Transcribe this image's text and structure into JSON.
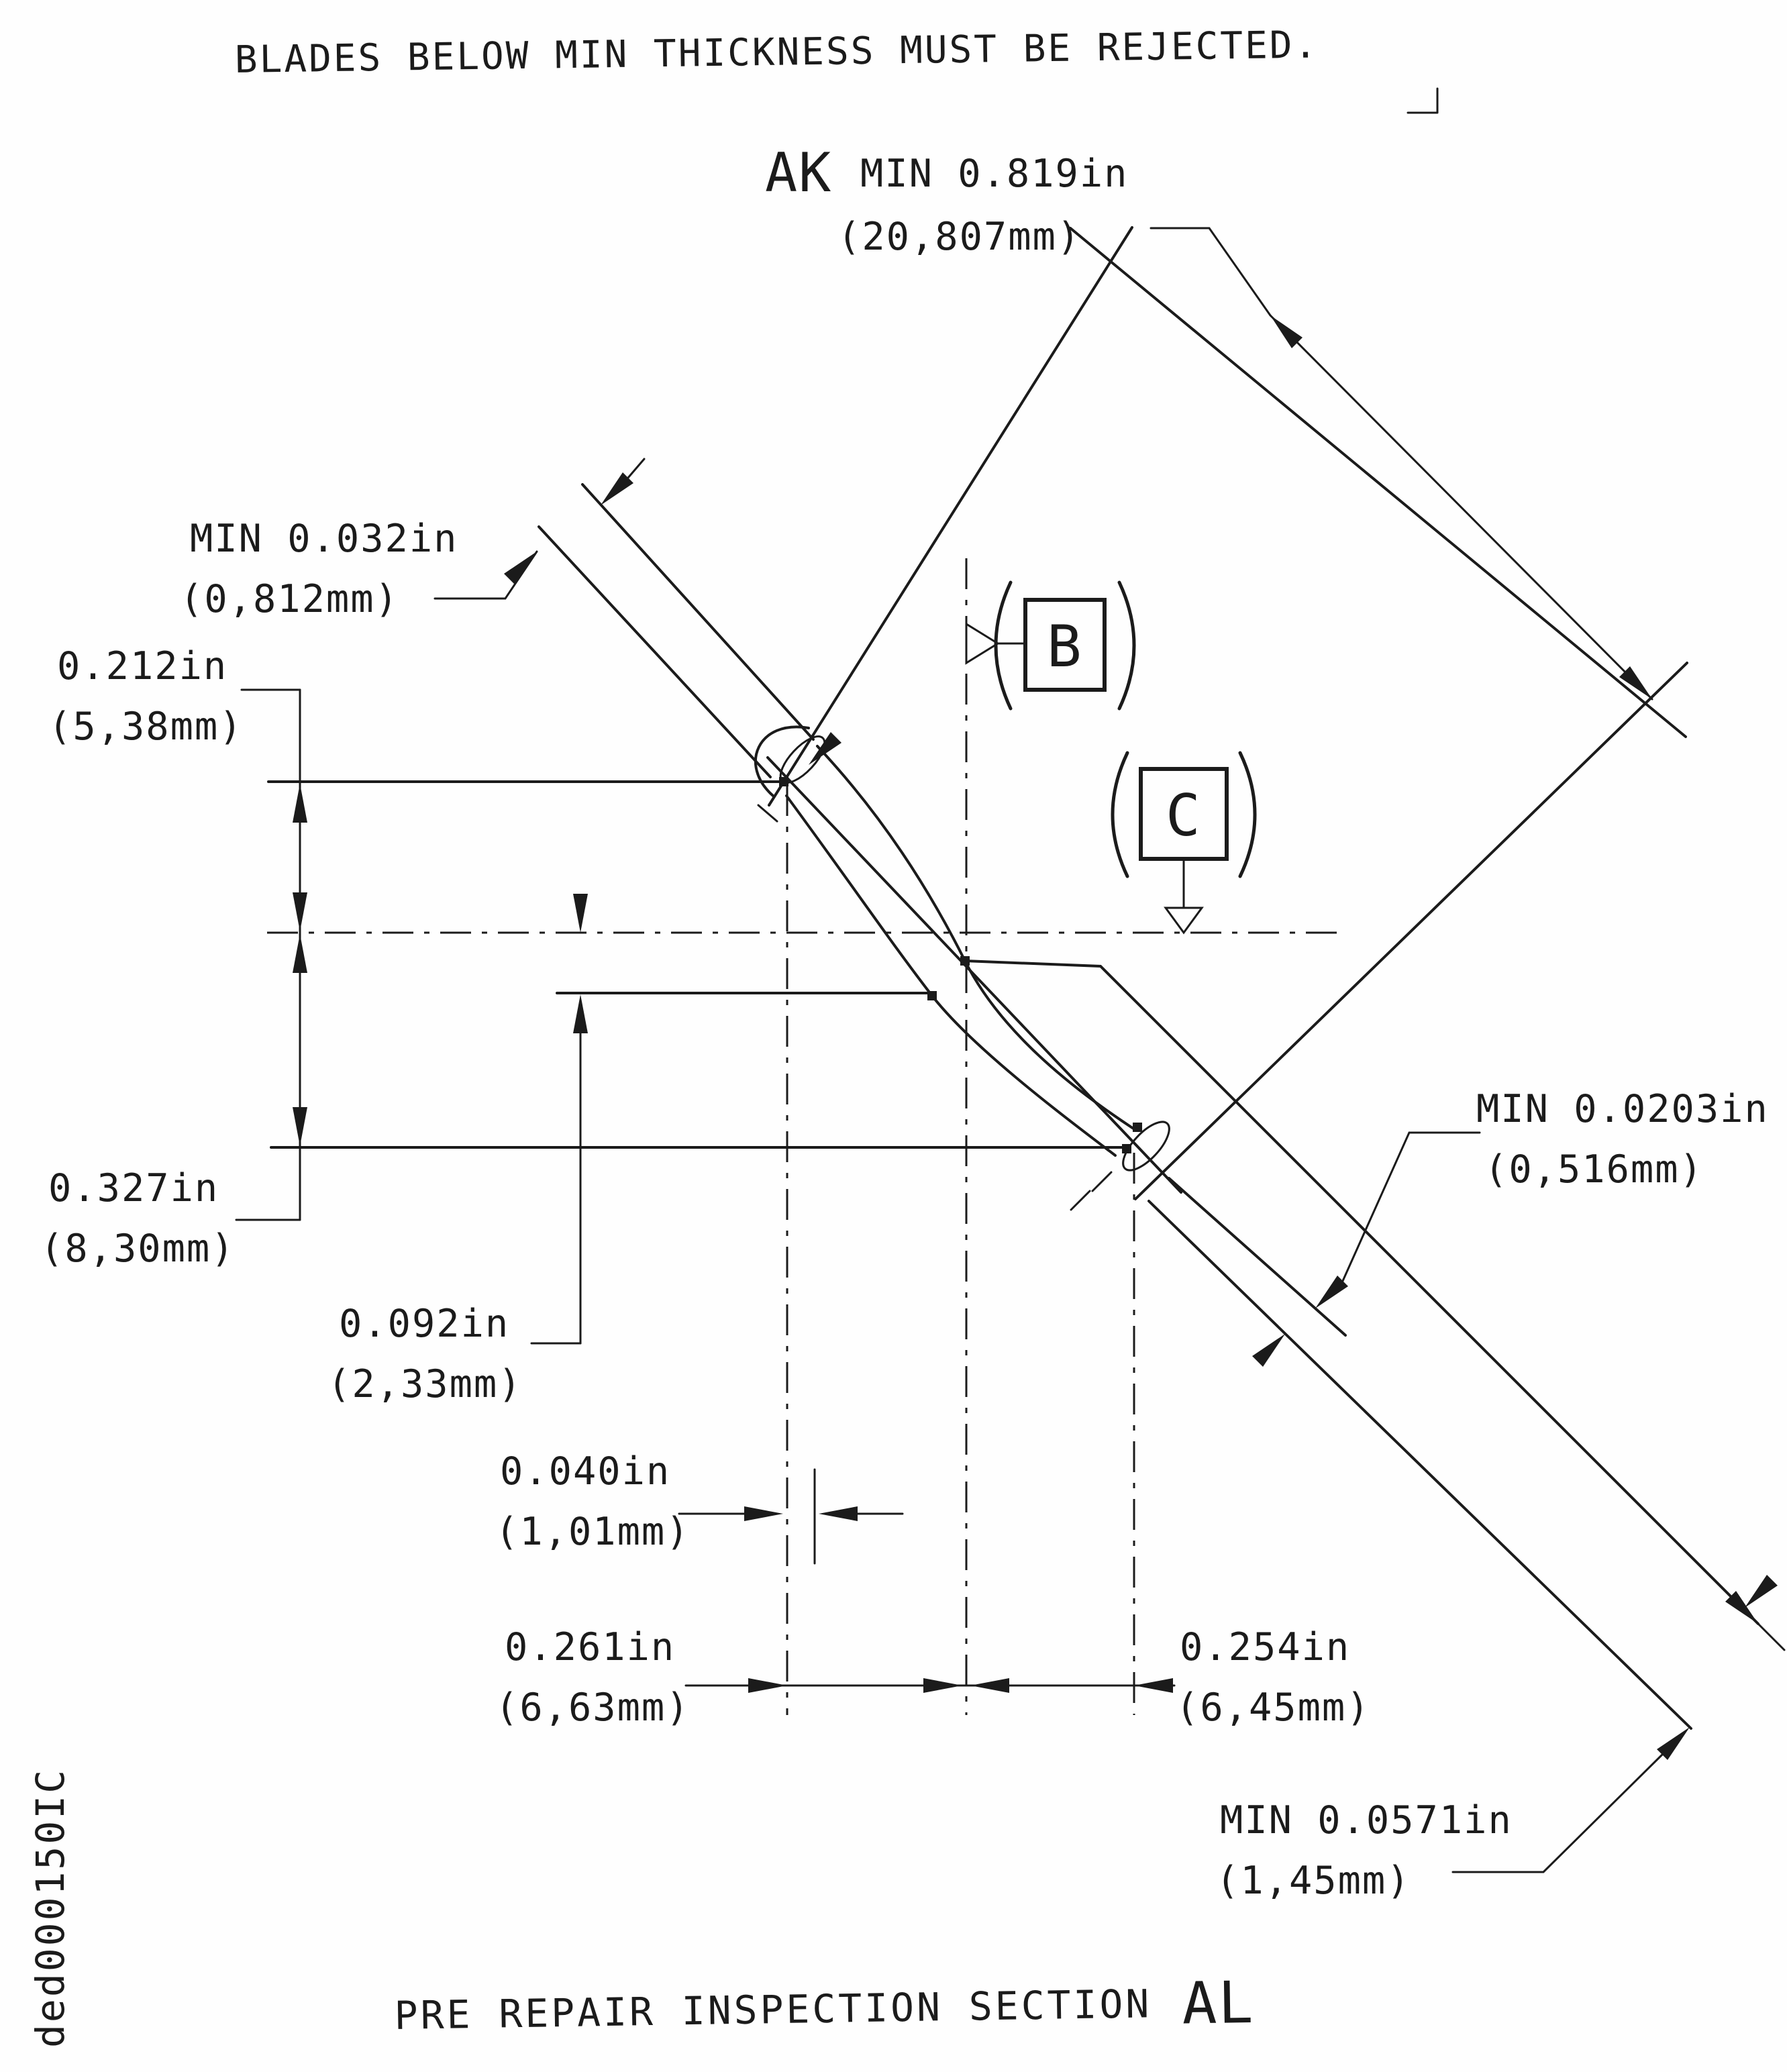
{
  "title": "BLADES BELOW MIN THICKNESS MUST BE REJECTED.",
  "footer": {
    "caption": "PRE REPAIR INSPECTION SECTION",
    "section": "AL",
    "doc_number": "ded000150IC"
  },
  "datum_flags": {
    "b": "B",
    "c": "C"
  },
  "dims": {
    "ak": {
      "prefix": "AK",
      "value": "MIN 0.819in",
      "metric": "(20,807mm)"
    },
    "tip_min": {
      "value": "MIN 0.032in",
      "metric": "(0,812mm)"
    },
    "d212": {
      "value": "0.212in",
      "metric": "(5,38mm)"
    },
    "d327": {
      "value": "0.327in",
      "metric": "(8,30mm)"
    },
    "d092": {
      "value": "0.092in",
      "metric": "(2,33mm)"
    },
    "d040": {
      "value": "0.040in",
      "metric": "(1,01mm)"
    },
    "d261": {
      "value": "0.261in",
      "metric": "(6,63mm)"
    },
    "d254": {
      "value": "0.254in",
      "metric": "(6,45mm)"
    },
    "te_min": {
      "value": "MIN 0.0203in",
      "metric": "(0,516mm)"
    },
    "root_min": {
      "value": "MIN 0.0571in",
      "metric": "(1,45mm)"
    }
  }
}
